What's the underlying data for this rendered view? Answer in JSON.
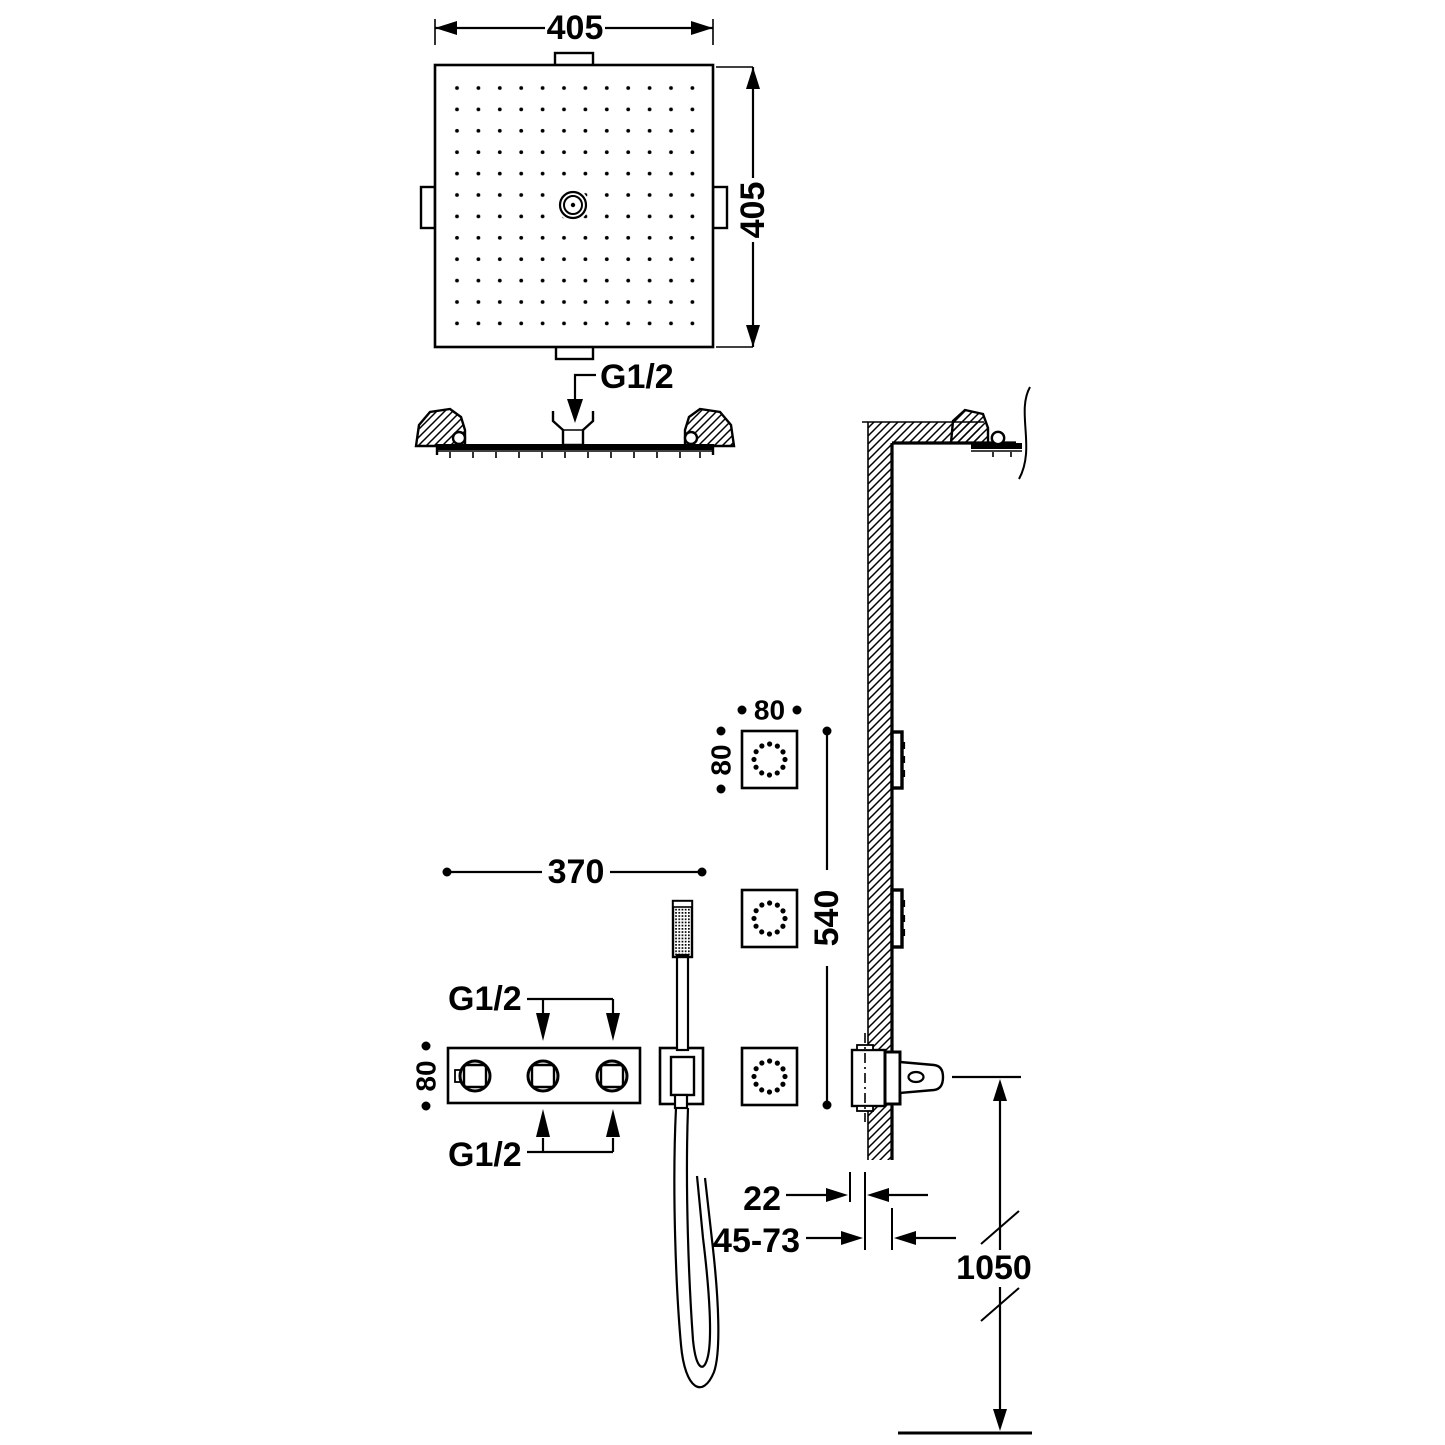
{
  "page": {
    "background": "#ffffff",
    "line_color": "#000000",
    "drawing_type": "shower-system-installation-dimensions"
  },
  "labels": {
    "head": {
      "width": "405",
      "height": "405",
      "inlet": "G1/2"
    },
    "jets": {
      "width": "80",
      "height": "80",
      "spacing": "540"
    },
    "mixer": {
      "width": "370",
      "height": "80",
      "inlet_top": "G1/2",
      "inlet_bottom": "G1/2"
    },
    "install": {
      "trim_depth": "22",
      "recess_depth": "45-73",
      "height_from_floor": "1050"
    }
  }
}
